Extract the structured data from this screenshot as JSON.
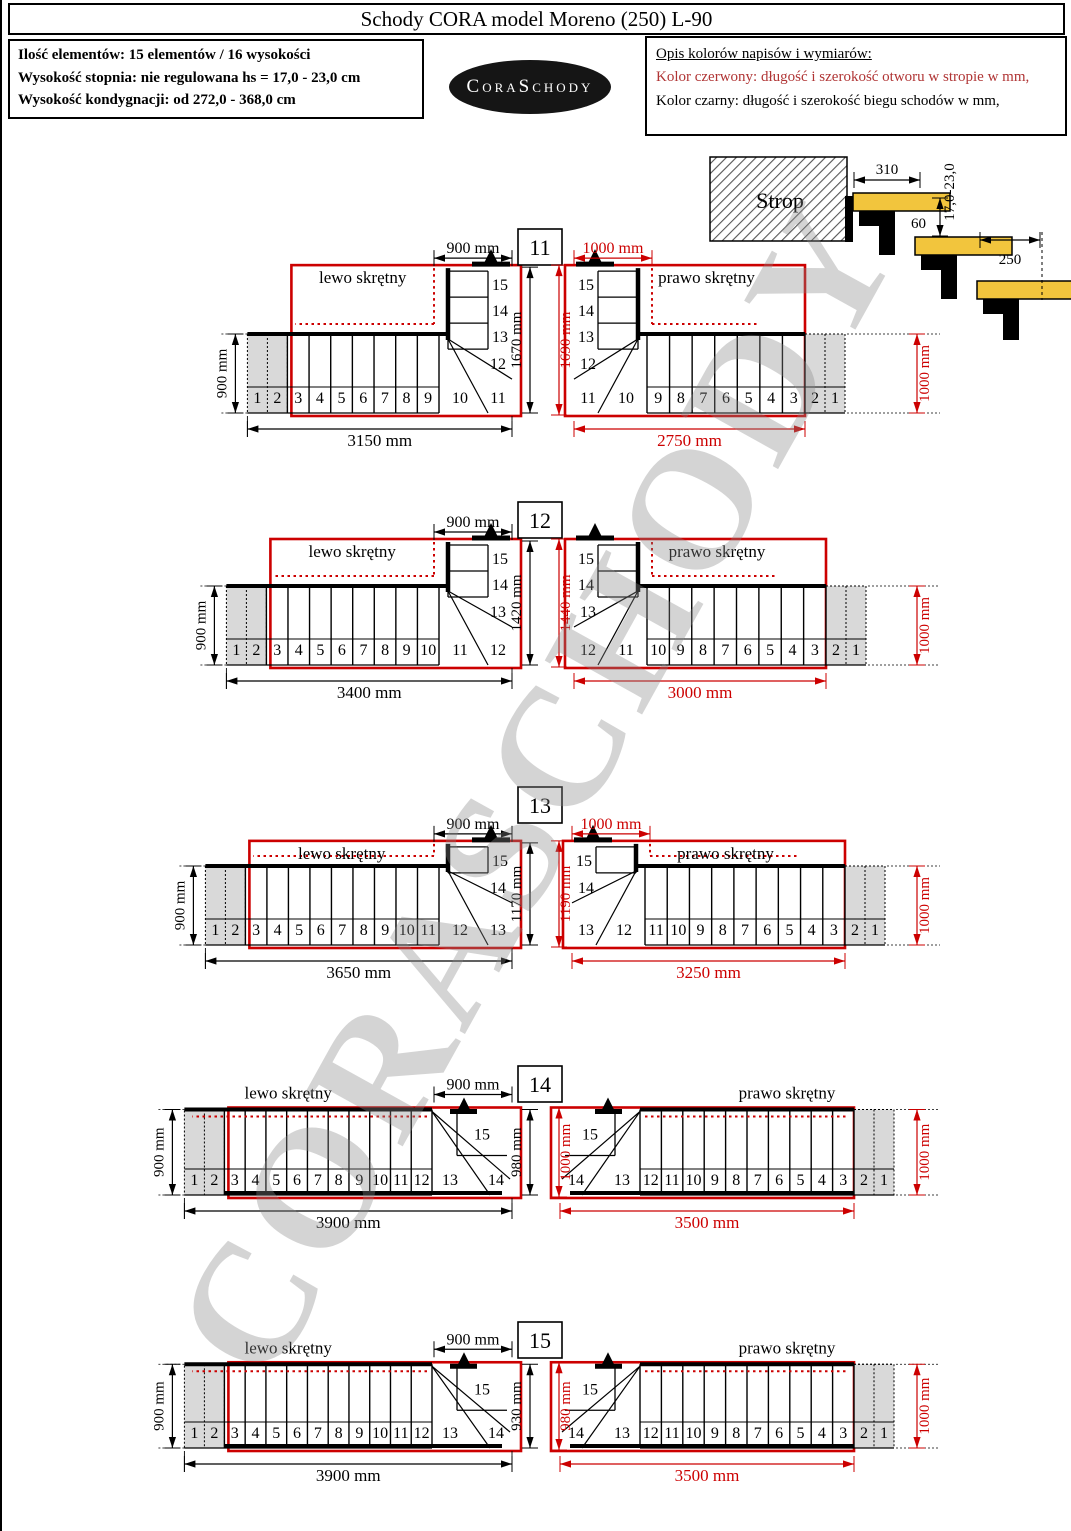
{
  "page": {
    "title": "Schody CORA model Moreno (250) L-90"
  },
  "info_box": {
    "lines": [
      "Ilość elementów: 15 elementów / 16 wysokości",
      "Wysokość stopnia: nie regulowana  hs = 17,0 - 23,0 cm",
      "Wysokość kondygnacji: od 272,0 - 368,0 cm"
    ]
  },
  "legend_box": {
    "title": "Opis kolorów napisów i wymiarów:",
    "red_line": "Kolor czerwony: długość i szerokość otworu w stropie w mm,",
    "black_line": "Kolor czarny: długość i szerokość biegu schodów w mm,"
  },
  "logo_text": "CoraSchody",
  "watermark": "CORASCHODY",
  "side_view": {
    "label": "Strop",
    "dim_tread": "310",
    "dim_height": "17,0-23,0",
    "dim_gap": "60",
    "dim_element": "250"
  },
  "colors": {
    "red": "#cc0000",
    "black": "#000000",
    "gray_fill": "#d9d9d9",
    "yellow": "#f2c53d",
    "watermark_gray": "#878787"
  },
  "diagrams": {
    "left_label": "lewo skrętny",
    "right_label": "prawo skrętny",
    "variants": [
      {
        "id": "11",
        "left": {
          "bottom": "3150 mm",
          "bottom_mm": 3150,
          "top_dim": "900 mm",
          "side_dim": "900 mm",
          "col": [
            "15",
            "14",
            "13"
          ],
          "winder": "12",
          "fan": [
            "10",
            "11"
          ],
          "straight": [
            "9",
            "8",
            "7",
            "6",
            "5",
            "4",
            "3"
          ],
          "gray": [
            "1",
            "2"
          ]
        },
        "mid": {
          "black": "1670 mm",
          "black_mm": 1670,
          "red": "1690 mm",
          "red_mm": 1690
        },
        "right": {
          "bottom": "2750 mm",
          "bottom_mm": 2750,
          "top_dim": "1000 mm",
          "side_dim": "1000 mm",
          "col": [
            "15",
            "14",
            "13"
          ],
          "winder": "12",
          "fan": [
            "10",
            "11"
          ],
          "straight": [
            "9",
            "8",
            "7",
            "6",
            "5",
            "4",
            "3"
          ],
          "gray": [
            "1",
            "2"
          ]
        }
      },
      {
        "id": "12",
        "left": {
          "bottom": "3400 mm",
          "bottom_mm": 3400,
          "top_dim": "900 mm",
          "side_dim": "900 mm",
          "col": [
            "15",
            "14"
          ],
          "winder": "13",
          "fan": [
            "11",
            "12"
          ],
          "straight": [
            "10",
            "9",
            "8",
            "7",
            "6",
            "5",
            "4",
            "3"
          ],
          "gray": [
            "1",
            "2"
          ]
        },
        "mid": {
          "black": "1420 mm",
          "black_mm": 1420,
          "red": "1440 mm",
          "red_mm": 1440
        },
        "right": {
          "bottom": "3000 mm",
          "bottom_mm": 3000,
          "top_dim": null,
          "side_dim": "1000 mm",
          "col": [
            "15",
            "14"
          ],
          "winder": "13",
          "fan": [
            "11",
            "12"
          ],
          "straight": [
            "10",
            "9",
            "8",
            "7",
            "6",
            "5",
            "4",
            "3"
          ],
          "gray": [
            "1",
            "2"
          ]
        }
      },
      {
        "id": "13",
        "left": {
          "bottom": "3650 mm",
          "bottom_mm": 3650,
          "top_dim": "900 mm",
          "side_dim": "900 mm",
          "col": [
            "15"
          ],
          "winder": "14",
          "fan": [
            "12",
            "13"
          ],
          "straight": [
            "11",
            "10",
            "9",
            "8",
            "7",
            "6",
            "5",
            "4",
            "3"
          ],
          "gray": [
            "1",
            "2"
          ]
        },
        "mid": {
          "black": "1170 mm",
          "black_mm": 1170,
          "red": "1190 mm",
          "red_mm": 1190
        },
        "right": {
          "bottom": "3250 mm",
          "bottom_mm": 3250,
          "top_dim": "1000 mm",
          "side_dim": "1000 mm",
          "col": [
            "15"
          ],
          "winder": "14",
          "fan": [
            "12",
            "13"
          ],
          "straight": [
            "11",
            "10",
            "9",
            "8",
            "7",
            "6",
            "5",
            "4",
            "3"
          ],
          "gray": [
            "1",
            "2"
          ]
        }
      },
      {
        "id": "14",
        "left": {
          "bottom": "3900 mm",
          "bottom_mm": 3900,
          "top_dim": "900 mm",
          "side_dim": "900 mm",
          "col": [],
          "top_cell": "15",
          "fan": [
            "13",
            "14"
          ],
          "straight": [
            "12",
            "11",
            "10",
            "9",
            "8",
            "7",
            "6",
            "5",
            "4",
            "3"
          ],
          "gray": [
            "1",
            "2"
          ]
        },
        "mid": {
          "black": "980 mm",
          "black_mm": 980,
          "red": "1000 mm",
          "red_mm": 1000
        },
        "right": {
          "bottom": "3500 mm",
          "bottom_mm": 3500,
          "top_dim": null,
          "side_dim": "1000 mm",
          "col": [],
          "top_cell": "15",
          "fan": [
            "13",
            "14"
          ],
          "straight": [
            "12",
            "11",
            "10",
            "9",
            "8",
            "7",
            "6",
            "5",
            "4",
            "3"
          ],
          "gray": [
            "1",
            "2"
          ]
        }
      },
      {
        "id": "15",
        "left": {
          "bottom": "3900 mm",
          "bottom_mm": 3900,
          "top_dim": "900 mm",
          "side_dim": "900 mm",
          "col": [],
          "top_cell": "15",
          "fan": [
            "13",
            "14"
          ],
          "straight": [
            "12",
            "11",
            "10",
            "9",
            "8",
            "7",
            "6",
            "5",
            "4",
            "3"
          ],
          "gray": [
            "1",
            "2"
          ]
        },
        "mid": {
          "black": "930 mm",
          "black_mm": 930,
          "red": "980 mm",
          "red_mm": 980
        },
        "right": {
          "bottom": "3500 mm",
          "bottom_mm": 3500,
          "top_dim": null,
          "side_dim": "1000 mm",
          "col": [],
          "top_cell": "15",
          "fan": [
            "13",
            "14"
          ],
          "straight": [
            "12",
            "11",
            "10",
            "9",
            "8",
            "7",
            "6",
            "5",
            "4",
            "3"
          ],
          "gray": [
            "1",
            "2"
          ]
        }
      }
    ]
  }
}
